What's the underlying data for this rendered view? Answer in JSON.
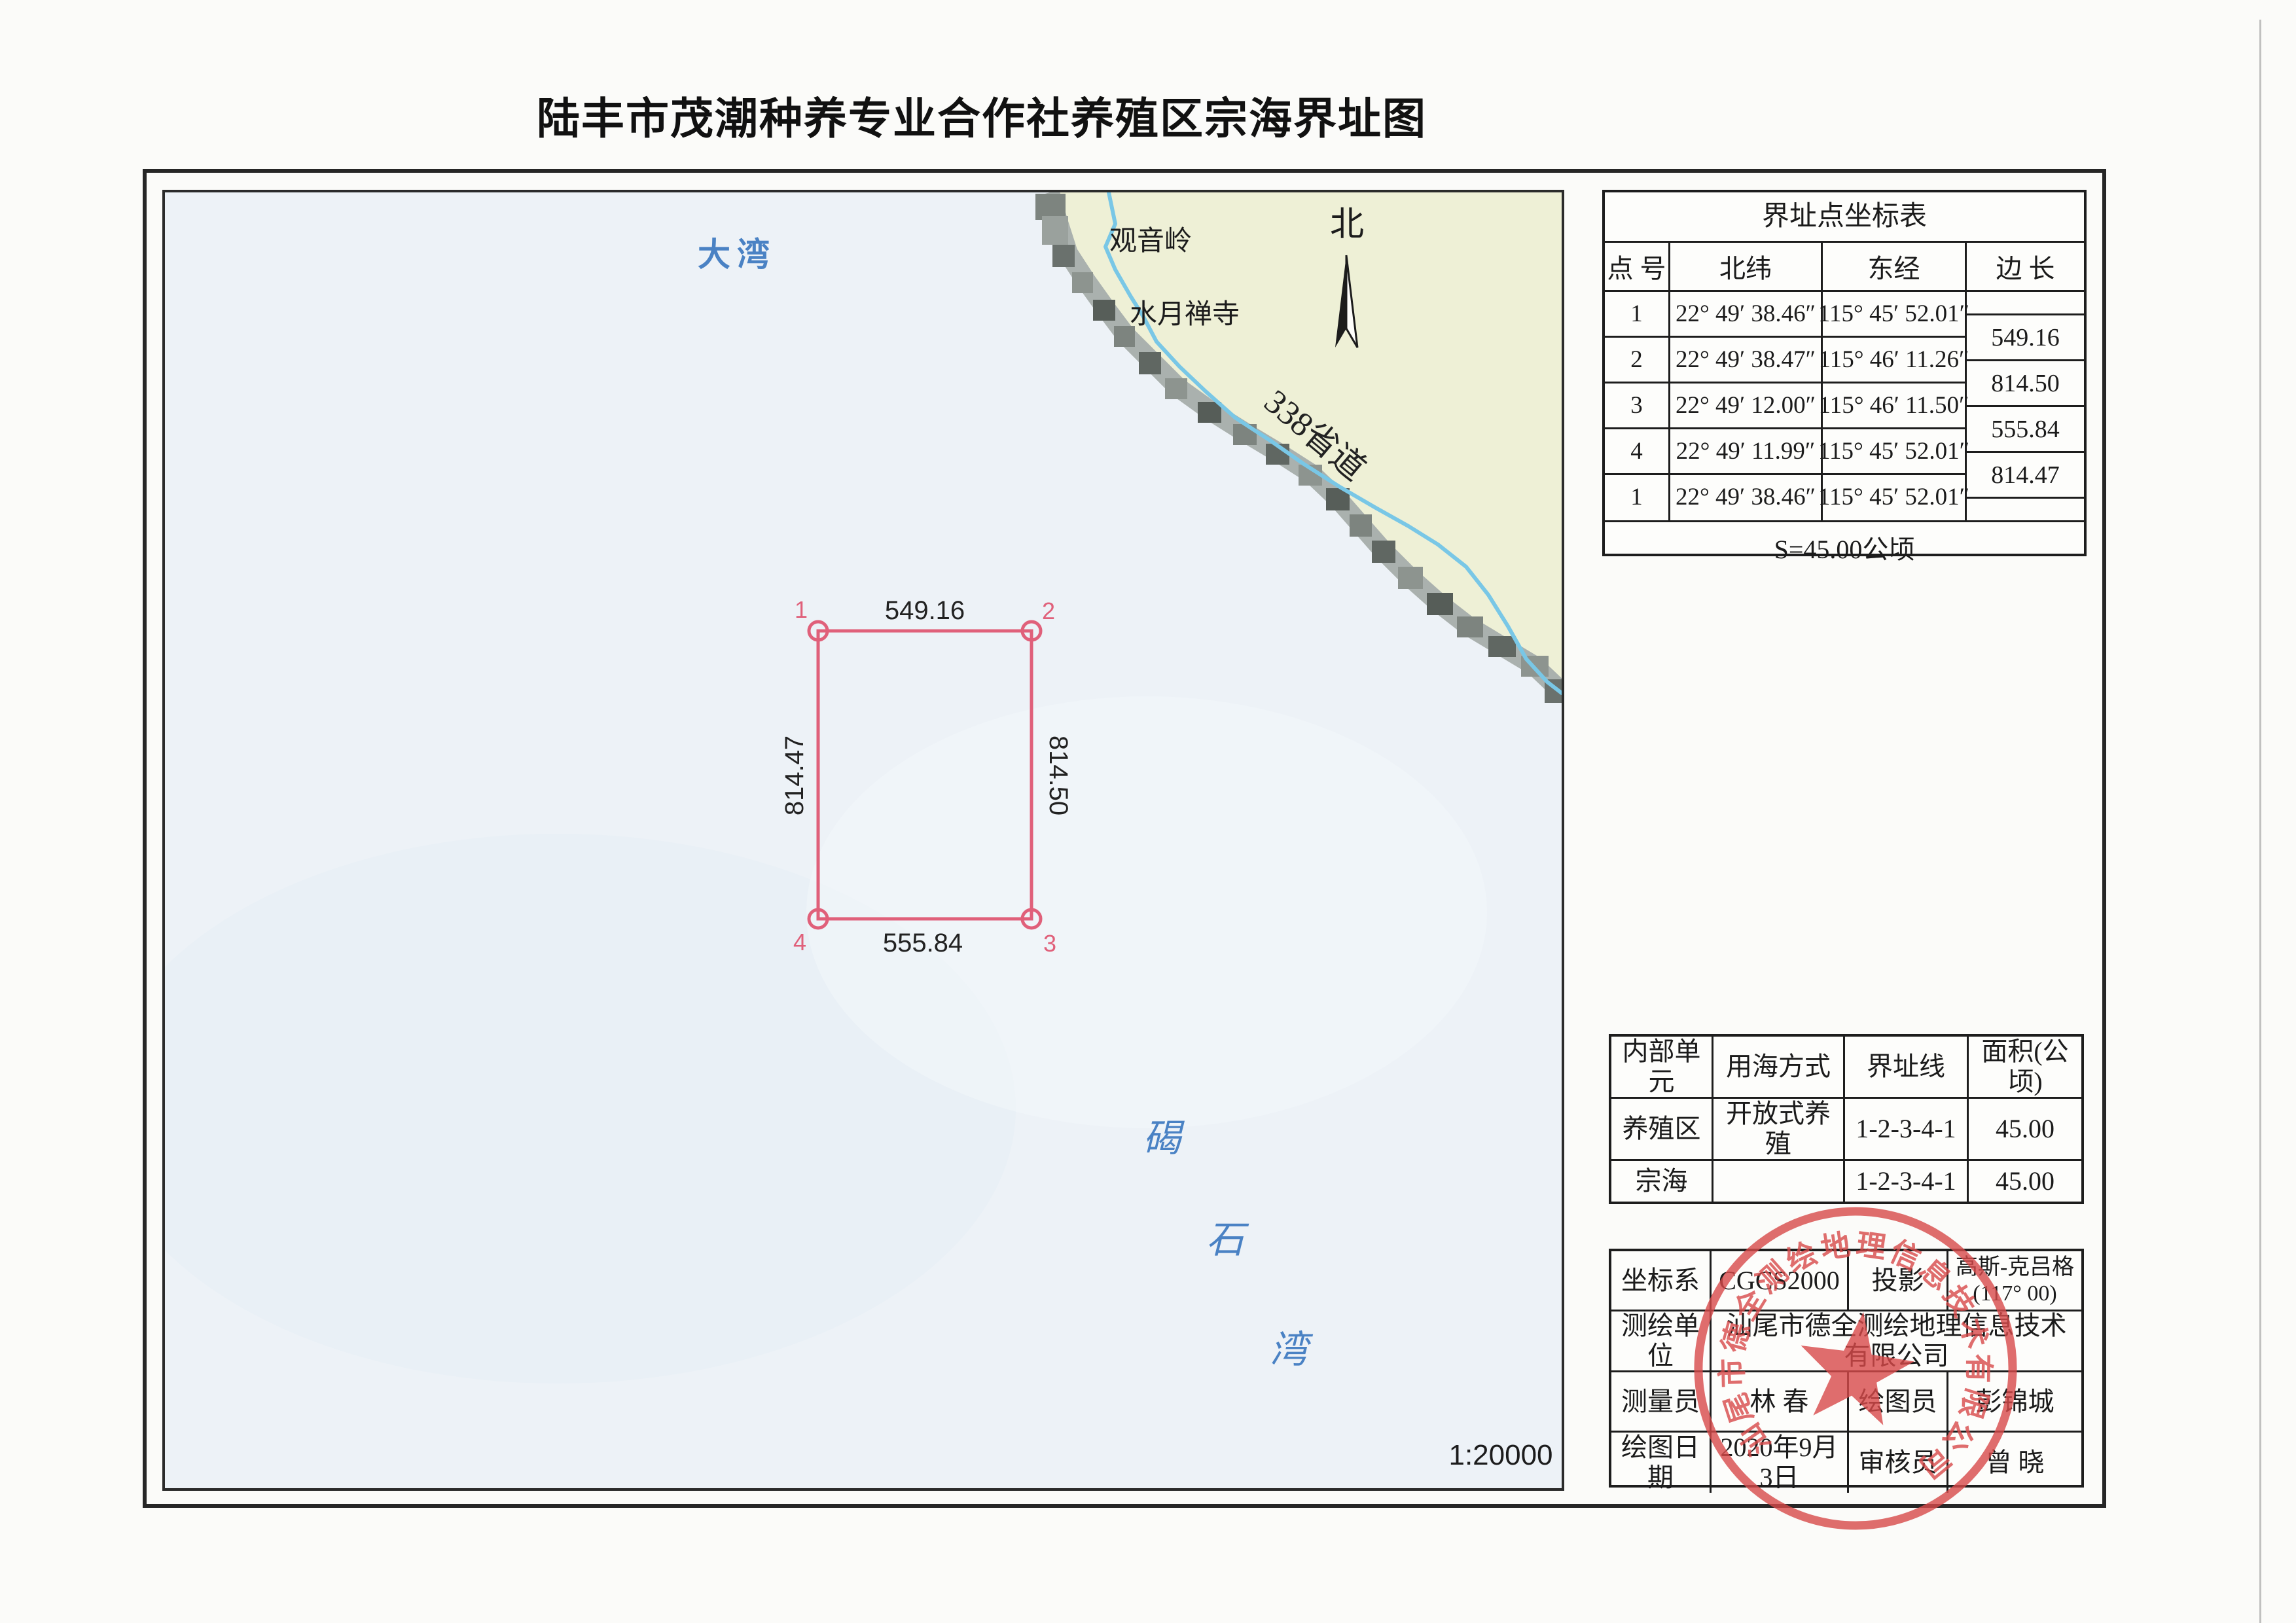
{
  "title": "陆丰市茂潮种养专业合作社养殖区宗海界址图",
  "map": {
    "sea_label": "大湾",
    "bay_chars": [
      "碣",
      "石",
      "湾"
    ],
    "mountain_label": "观音岭",
    "temple_label": "水月禅寺",
    "road_label": "338省道",
    "north_label": "北",
    "scale_label": "1:20000",
    "colors": {
      "sea": "#edf2f7",
      "land": "#eef0d6",
      "river": "#79c7e6",
      "plot_red": "#e0607a",
      "blue_text": "#4a82c4"
    }
  },
  "plot": {
    "corners": [
      "1",
      "2",
      "3",
      "4"
    ],
    "side_top": "549.16",
    "side_right": "814.50",
    "side_bottom": "555.84",
    "side_left": "814.47"
  },
  "coord_table": {
    "title": "界址点坐标表",
    "headers": {
      "no": "点 号",
      "lat": "北纬",
      "lon": "东经",
      "side": "边 长"
    },
    "rows": [
      {
        "no": "1",
        "lat": "22° 49′ 38.46″",
        "lon": "115° 45′ 52.01″"
      },
      {
        "no": "2",
        "lat": "22° 49′ 38.47″",
        "lon": "115° 46′ 11.26″"
      },
      {
        "no": "3",
        "lat": "22° 49′ 12.00″",
        "lon": "115° 46′ 11.50″"
      },
      {
        "no": "4",
        "lat": "22° 49′ 11.99″",
        "lon": "115° 45′ 52.01″"
      },
      {
        "no": "1",
        "lat": "22° 49′ 38.46″",
        "lon": "115° 45′ 52.01″"
      }
    ],
    "side_lengths": [
      "549.16",
      "814.50",
      "555.84",
      "814.47"
    ],
    "area": "S=45.00公顷"
  },
  "unit_table": {
    "headers": [
      "内部单元",
      "用海方式",
      "界址线",
      "面积(公顷)"
    ],
    "rows": [
      [
        "养殖区",
        "开放式养殖",
        "1-2-3-4-1",
        "45.00"
      ],
      [
        "宗海",
        "",
        "1-2-3-4-1",
        "45.00"
      ]
    ]
  },
  "info_table": {
    "coord_sys_label": "坐标系",
    "coord_sys_value": "CGCS2000",
    "projection_label": "投影",
    "projection_line1": "高斯-克吕格",
    "projection_line2": "(117° 00)",
    "org_label": "测绘单位",
    "org_value": "汕尾市德全测绘地理信息技术有限公司",
    "surveyor_label": "测量员",
    "surveyor_value": "林  春",
    "drafter_label": "绘图员",
    "drafter_value": "彭锦城",
    "date_label": "绘图日期",
    "date_value": "2020年9月3日",
    "reviewer_label": "审核员",
    "reviewer_value": "曾  晓"
  },
  "stamp": {
    "text": "汕尾市德全测绘地理信息技术有限公司",
    "color": "#d84a4a"
  }
}
